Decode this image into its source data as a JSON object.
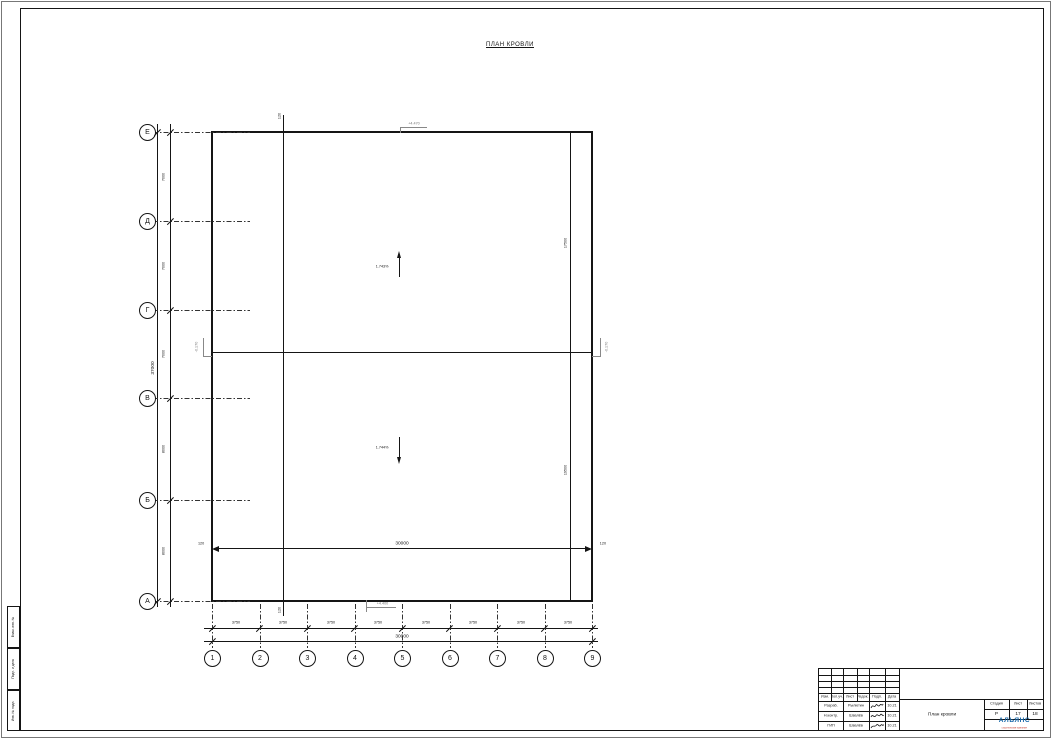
{
  "sheet": {
    "drawing_title": "ПЛАН КРОВЛИ",
    "side_strip": [
      "Взам. инв. №",
      "Подп. и дата",
      "Инв. № подл."
    ]
  },
  "plan": {
    "bottom_axes": [
      "1",
      "2",
      "3",
      "4",
      "5",
      "6",
      "7",
      "8",
      "9"
    ],
    "left_axes": [
      "Е",
      "Д",
      "Г",
      "В",
      "Б",
      "А"
    ],
    "bottom_dims": [
      "3750",
      "3750",
      "3750",
      "3750",
      "3750",
      "3750",
      "3750",
      "3750"
    ],
    "bottom_total": "30000",
    "left_dims": [
      "7000",
      "7000",
      "7000",
      "8000",
      "8000"
    ],
    "left_total": "37000",
    "inner_dim_left": "120",
    "inner_dim_center": "30000",
    "inner_dim_right": "120",
    "parapet_dim_top": "120",
    "parapet_dim_bottom": "120",
    "right_dim_upper": "17500",
    "right_dim_lower": "19500",
    "slope_upper": "1.743%",
    "slope_lower": "1.744%",
    "level_mark_top": "+4.470",
    "level_mark_bottom": "+4.400",
    "ridge_mark_left": "-0.170",
    "ridge_mark_right": "-0.170"
  },
  "title_block": {
    "revision_header": [
      "Изм.",
      "Кол.уч.",
      "Лист",
      "№док.",
      "Подп.",
      "Дата"
    ],
    "rows": [
      {
        "role": "Разраб.",
        "name": "Рылютин",
        "date": "10.21"
      },
      {
        "role": "Н.контр.",
        "name": "Швалёв",
        "date": "10.21"
      },
      {
        "role": "ГИП",
        "name": "Швалёв",
        "date": "10.21"
      }
    ],
    "drawing_name": "План кровли",
    "stage_header": [
      "Стадия",
      "Лист",
      "Листов"
    ],
    "stage_value": "Р",
    "sheet_value": "17",
    "sheets_total_value": "18",
    "company_name": "АЛЬЯНС",
    "company_subtitle": "строительная компания",
    "brand_color": "#1466a8",
    "accent_red": "#c0392b"
  }
}
